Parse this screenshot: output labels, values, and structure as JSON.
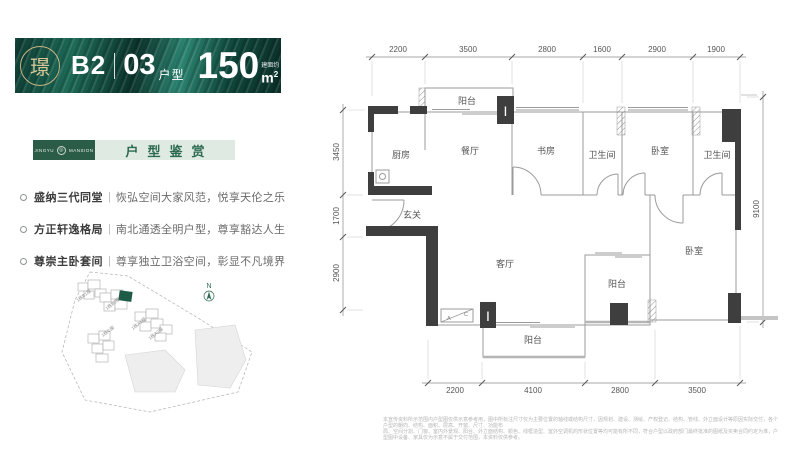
{
  "header": {
    "block": "B2",
    "divider": "|",
    "unit_number": "03",
    "unit_label": "户型",
    "area_value": "150",
    "area_note": "建面约",
    "area_unit": "m",
    "area_exp": "2",
    "seal_char": "璟"
  },
  "brand": {
    "name_left": "JINGYU",
    "name_right": "MANSION",
    "section_title": "户型鉴赏"
  },
  "selling_points": [
    {
      "title": "盛纳三代同堂",
      "sep": "|",
      "desc": "恢弘空间大家风范，悦享天伦之乐"
    },
    {
      "title": "方正轩逸格局",
      "sep": "|",
      "desc": "南北通透全明户型，尊享豁达人生"
    },
    {
      "title": "尊崇主卧套间",
      "sep": "|",
      "desc": "尊享独立卫浴空间，彰显不凡境界"
    }
  ],
  "siteplan": {
    "north": "N",
    "building_labels": [
      "1栋B1座",
      "1栋B2座",
      "1栋A1座",
      "1栋A2座",
      "1栋C座"
    ]
  },
  "plan": {
    "rooms": [
      "阳台",
      "厨房",
      "餐厅",
      "书房",
      "卫生间",
      "卧室",
      "卫生间",
      "玄关",
      "客厅",
      "卧室",
      "阳台",
      "阳台"
    ],
    "dims_top": [
      "2200",
      "3500",
      "2800",
      "1600",
      "2900",
      "1900"
    ],
    "dims_left": [
      "3450",
      "1700",
      "2900"
    ],
    "dims_right": [
      "9100"
    ],
    "dims_bottom": [
      "2200",
      "4100",
      "2800",
      "3500"
    ],
    "column_marker": "I",
    "ac_a": "A",
    "ac_c": "C"
  },
  "disclaimer": {
    "line1": "本宣传资料所示范围内户型图仅供示意参考用，图中所标注尺寸仅为主要位置的轴线或结构尺寸，因规划、建设、测绘、产权登记、结构、管线、外立面设计等原因实际交付，各个户型的朝向、结构、面积、层高、开窗、尺寸、功能布",
    "line2": "局、空间分割、门窗、室内外景观、阳台、外立面结构、颜色、线框造型、室外空调机的形状位置等均可能有所不同，符合户型以政府部门最终批准的图纸及买卖合同约定为准，户型图中设备、家具仅为示意不属于交付范围，本资料仅供参考。"
  },
  "colors": {
    "banner_green": "#14483c",
    "brand_green": "#2b5c48",
    "bar_green": "#dfeae2",
    "accent_green": "#2c6a50",
    "wall_dark": "#3e3e3e",
    "seal_gold": "#c9b483",
    "highlight_building": "#1f5c45"
  }
}
